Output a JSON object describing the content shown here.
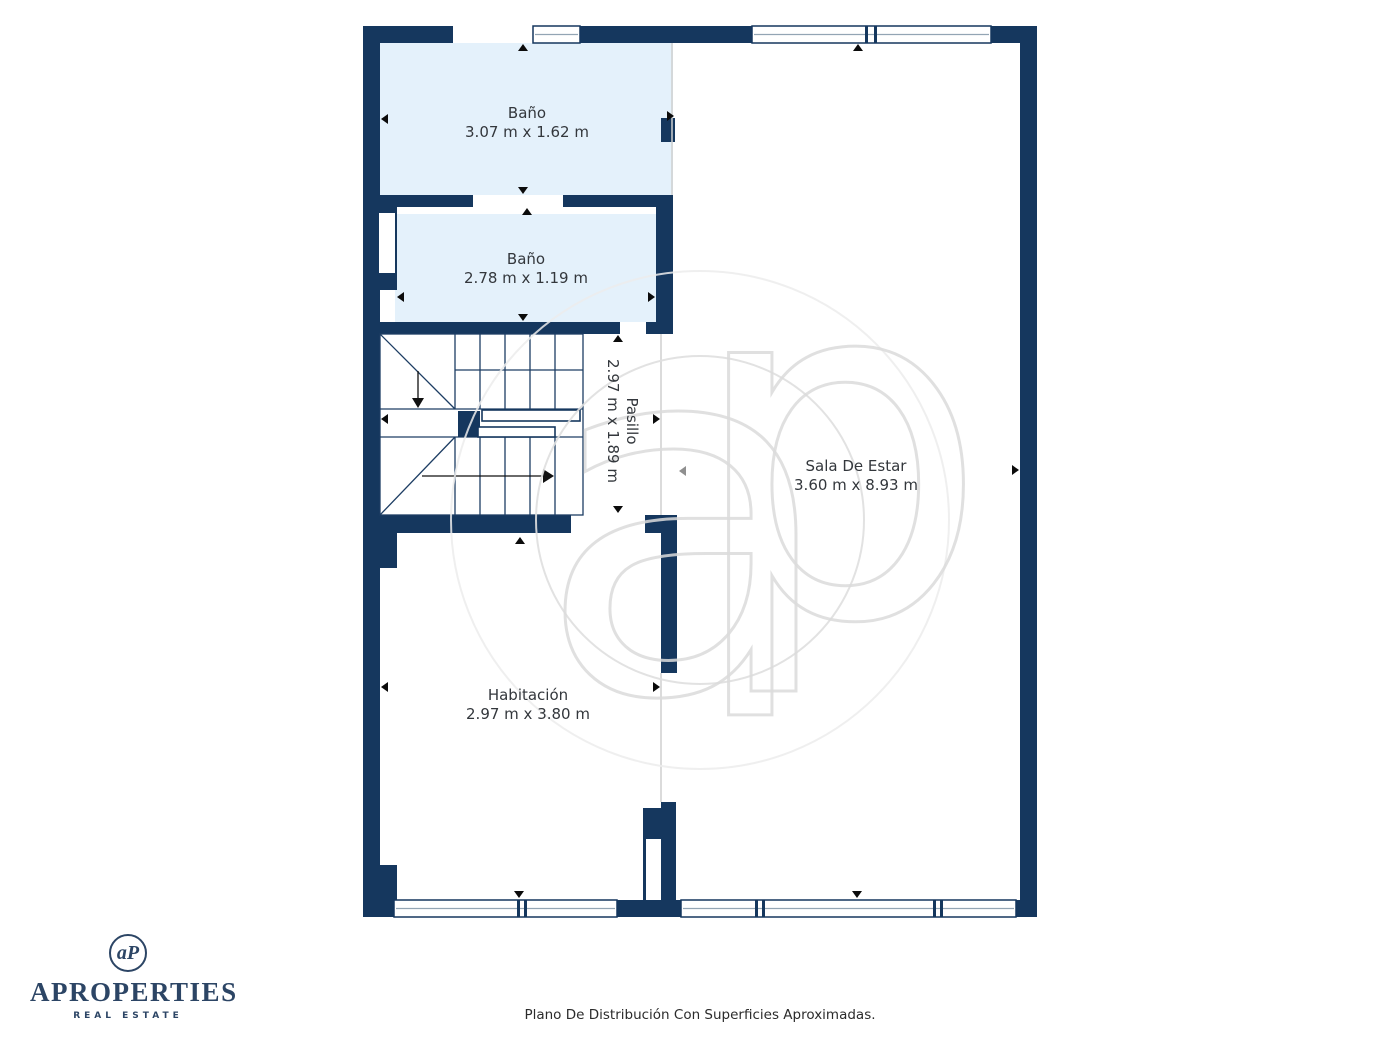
{
  "document": {
    "kind": "floor-plan"
  },
  "colors": {
    "wall_navy": "#15375e",
    "bathroom_fill": "#e4f1fb",
    "room_boundary_gray": "#cfcfcf",
    "window_glass_line": "#93a5b4",
    "label_text": "#33373c",
    "brand_navy": "#2c4565",
    "watermark_gray": "#e0e0e0",
    "marker_black": "#0b0b0b"
  },
  "rooms": [
    {
      "id": "bano-1",
      "name": "Baño",
      "dimensions": "3.07 m x 1.62 m"
    },
    {
      "id": "bano-2",
      "name": "Baño",
      "dimensions": "2.78 m x 1.19 m"
    },
    {
      "id": "pasillo",
      "name": "Pasillo",
      "dimensions": "2.97 m x 1.89 m",
      "label_rotated": true
    },
    {
      "id": "sala-de-estar",
      "name": "Sala De Estar",
      "dimensions": "3.60 m x 8.93 m"
    },
    {
      "id": "habitacion",
      "name": "Habitación",
      "dimensions": "2.97 m x 3.80 m"
    }
  ],
  "branding": {
    "monogram": "aP",
    "company": "APROPERTIES",
    "tagline": "REAL ESTATE"
  },
  "watermark": {
    "letter_a": "a",
    "letter_p": "p"
  },
  "caption": "Plano De Distribución Con Superficies Aproximadas."
}
